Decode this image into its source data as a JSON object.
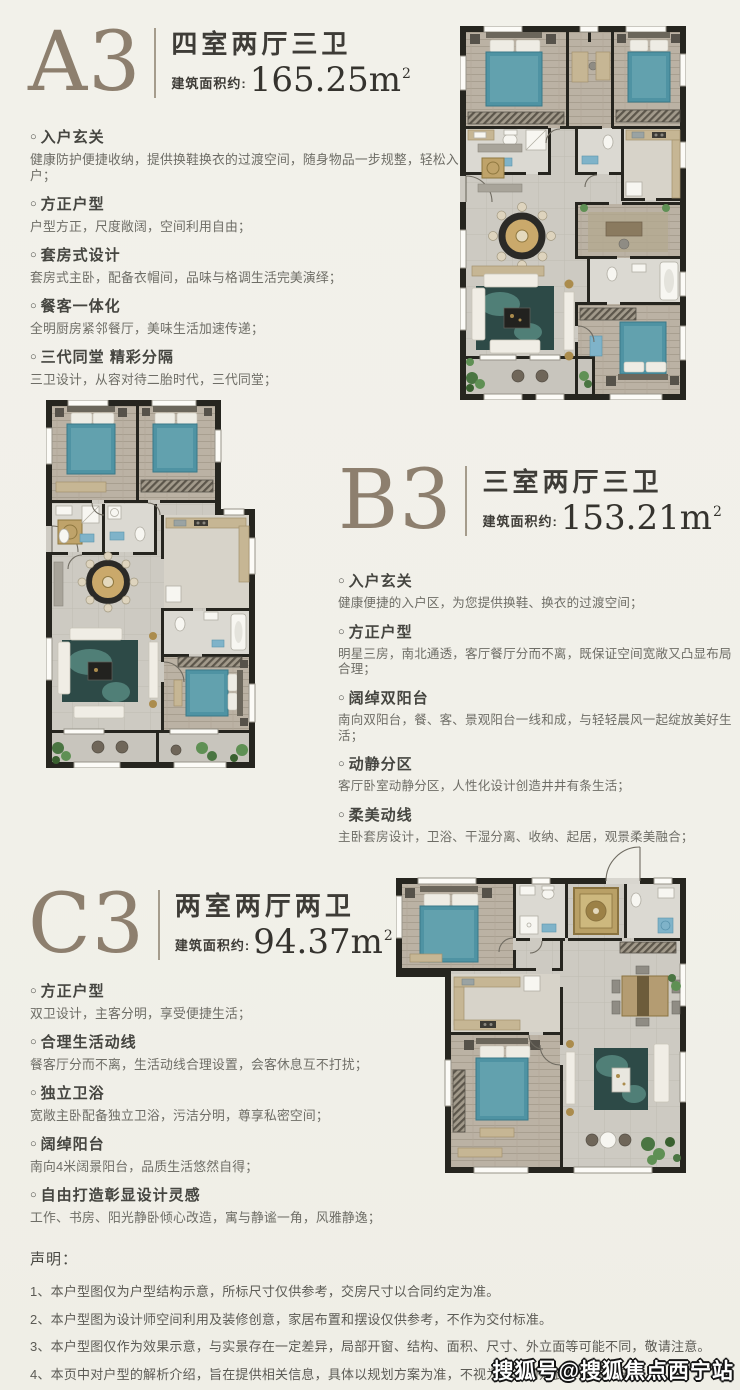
{
  "ui": {
    "marker": "○"
  },
  "watermark": "搜狐号@搜狐焦点西宁站",
  "colors": {
    "page_background": "#f1f0e9",
    "unit_letter": "#8d7f6e",
    "heading_text": "#3e3c37",
    "body_text": "#6e6d66",
    "plan_wall": "#26251f",
    "bed_teal": "#4f93a3",
    "rug_teal": "#2d4a47",
    "accent_gold": "#ab8c4d",
    "watermark_fill": "#ffffff",
    "watermark_outline": "#141414"
  },
  "sections": [
    {
      "letter": "A3",
      "layout": "四室两厅三卫",
      "area_prefix": "建筑面积约:",
      "area_value": "165.25",
      "area_unit": "m",
      "area_sup": "2",
      "features": [
        {
          "title": "入户玄关",
          "desc": "健康防护便捷收纳，提供换鞋换衣的过渡空间，随身物品一步规整，轻松入户；"
        },
        {
          "title": "方正户型",
          "desc": "户型方正，尺度敞阔，空间利用自由；"
        },
        {
          "title": "套房式设计",
          "desc": "套房式主卧，配备衣帽间，品味与格调生活完美演绎；"
        },
        {
          "title": "餐客一体化",
          "desc": "全明厨房紧邻餐厅，美味生活加速传递；"
        },
        {
          "title": "三代同堂 精彩分隔",
          "desc": "三卫设计，从容对待二胎时代，三代同堂；"
        }
      ]
    },
    {
      "letter": "B3",
      "layout": "三室两厅三卫",
      "area_prefix": "建筑面积约:",
      "area_value": "153.21",
      "area_unit": "m",
      "area_sup": "2",
      "features": [
        {
          "title": "入户玄关",
          "desc": "健康便捷的入户区，为您提供换鞋、换衣的过渡空间；"
        },
        {
          "title": "方正户型",
          "desc": "明星三房，南北通透，客厅餐厅分而不离，既保证空间宽敞又凸显布局合理；"
        },
        {
          "title": "阔绰双阳台",
          "desc": "南向双阳台，餐、客、景观阳台一线和成，与轻轻晨风一起绽放美好生活；"
        },
        {
          "title": "动静分区",
          "desc": "客厅卧室动静分区，人性化设计创造井井有条生活；"
        },
        {
          "title": "柔美动线",
          "desc": "主卧套房设计，卫浴、干湿分离、收纳、起居，观景柔美融合；"
        }
      ]
    },
    {
      "letter": "C3",
      "layout": "两室两厅两卫",
      "area_prefix": "建筑面积约:",
      "area_value": "94.37",
      "area_unit": "m",
      "area_sup": "2",
      "features": [
        {
          "title": "方正户型",
          "desc": "双卫设计，主客分明，享受便捷生活；"
        },
        {
          "title": "合理生活动线",
          "desc": "餐客厅分而不离，生活动线合理设置，会客休息互不打扰；"
        },
        {
          "title": "独立卫浴",
          "desc": "宽敞主卧配备独立卫浴，污洁分明，尊享私密空间；"
        },
        {
          "title": "阔绰阳台",
          "desc": "南向4米阔景阳台，品质生活悠然自得；"
        },
        {
          "title": "自由打造彰显设计灵感",
          "desc": "工作、书房、阳光静卧倾心改造，寓与静谧一角，风雅静逸；"
        }
      ]
    }
  ],
  "disclaimer": {
    "title": "声明：",
    "items": [
      "1、本户型图仅为户型结构示意，所标尺寸仅供参考，交房尺寸以合同约定为准。",
      "2、本户型图为设计师空间利用及装修创意，家居布置和摆设仅供参考，不作为交付标准。",
      "3、本户型图仅作为效果示意，与实景存在一定差异，局部开窗、结构、面积、尺寸、外立面等可能不同，敬请注意。",
      "4、本页中对户型的解析介绍，旨在提供相关信息，具体以规划方案为准，不视为本公司对此作出的承诺。"
    ]
  }
}
